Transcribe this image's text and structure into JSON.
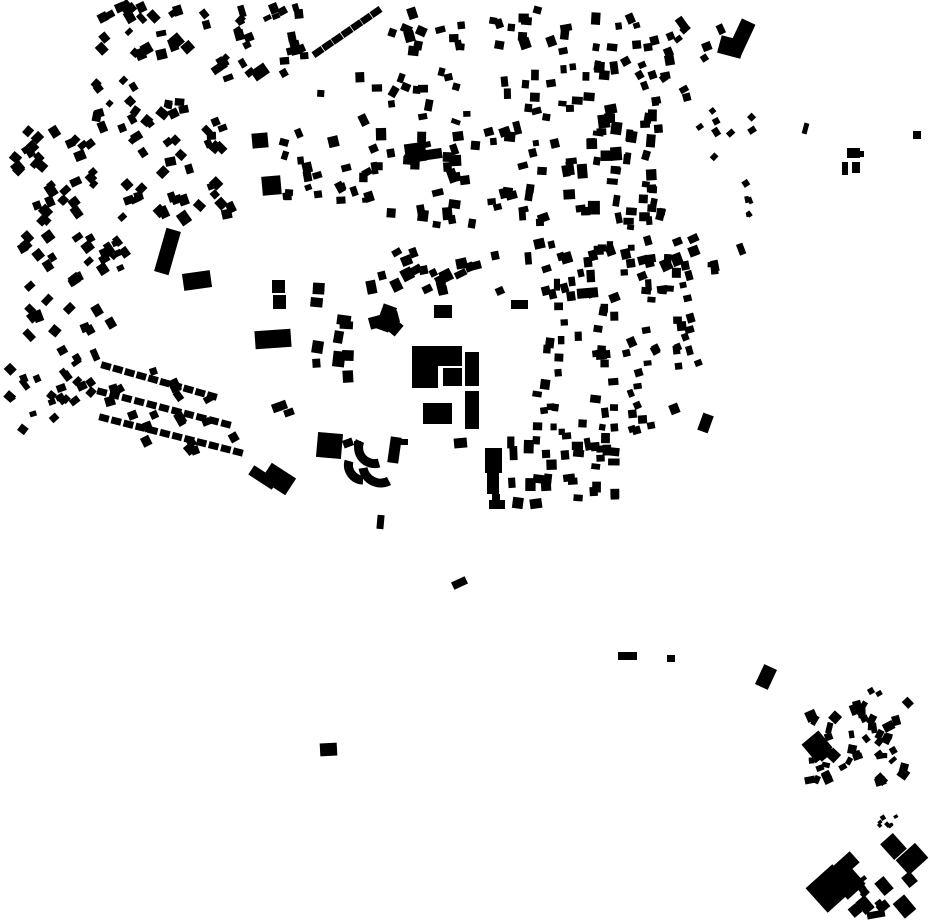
{
  "map": {
    "kind": "figure-ground building footprint map",
    "width": 930,
    "height": 924,
    "background_color": "#ffffff",
    "building_color": "#000000"
  },
  "chart_data": {
    "type": "table",
    "title": "",
    "note": "Map contains no text; data below are building footprints in pixel coordinates.",
    "buildings_xywhr": [
      [
        252,
        133,
        16,
        15,
        -5
      ],
      [
        262,
        176,
        19,
        19,
        -5
      ],
      [
        252,
        66,
        16,
        12,
        -35
      ],
      [
        160,
        229,
        15,
        45,
        16
      ],
      [
        183,
        272,
        28,
        17,
        -8
      ],
      [
        272,
        280,
        13,
        13,
        0
      ],
      [
        273,
        295,
        13,
        14,
        0
      ],
      [
        255,
        330,
        36,
        18,
        -4
      ],
      [
        272,
        402,
        15,
        9,
        -20
      ],
      [
        284,
        409,
        10,
        7,
        -20
      ],
      [
        249,
        472,
        28,
        11,
        33
      ],
      [
        264,
        469,
        29,
        20,
        33
      ],
      [
        405,
        143,
        21,
        19,
        -8
      ],
      [
        426,
        149,
        16,
        10,
        -8
      ],
      [
        379,
        305,
        14,
        26,
        20
      ],
      [
        369,
        314,
        30,
        12,
        -15
      ],
      [
        385,
        319,
        16,
        14,
        40
      ],
      [
        434,
        305,
        18,
        13,
        0
      ],
      [
        511,
        300,
        17,
        9,
        0
      ],
      [
        577,
        288,
        21,
        10,
        -5
      ],
      [
        412,
        346,
        26,
        42,
        0
      ],
      [
        437,
        346,
        25,
        20,
        0
      ],
      [
        443,
        368,
        19,
        18,
        0
      ],
      [
        465,
        352,
        14,
        34,
        0
      ],
      [
        465,
        391,
        14,
        38,
        0
      ],
      [
        423,
        403,
        29,
        21,
        0
      ],
      [
        317,
        433,
        25,
        25,
        5
      ],
      [
        343,
        439,
        10,
        8,
        -20
      ],
      [
        354,
        441,
        7,
        6,
        0
      ],
      [
        389,
        437,
        11,
        26,
        8
      ],
      [
        398,
        439,
        10,
        6,
        0
      ],
      [
        454,
        438,
        13,
        10,
        -5
      ],
      [
        485,
        448,
        17,
        25,
        0
      ],
      [
        487,
        470,
        12,
        24,
        0
      ],
      [
        492,
        494,
        8,
        13,
        0
      ],
      [
        489,
        500,
        16,
        9,
        0
      ],
      [
        377,
        515,
        7,
        14,
        5
      ],
      [
        734,
        20,
        15,
        34,
        25
      ],
      [
        719,
        38,
        24,
        18,
        15
      ],
      [
        700,
        414,
        11,
        18,
        20
      ],
      [
        803,
        123,
        5,
        11,
        15
      ],
      [
        913,
        131,
        8,
        8,
        0
      ],
      [
        847,
        148,
        13,
        10,
        0
      ],
      [
        857,
        151,
        7,
        6,
        0
      ],
      [
        842,
        162,
        6,
        13,
        0
      ],
      [
        852,
        162,
        8,
        11,
        0
      ],
      [
        452,
        579,
        15,
        8,
        -25
      ],
      [
        320,
        743,
        17,
        13,
        -3
      ],
      [
        618,
        652,
        19,
        8,
        0
      ],
      [
        667,
        655,
        8,
        7,
        0
      ],
      [
        759,
        666,
        14,
        22,
        25
      ],
      [
        868,
        688,
        6,
        6,
        -30
      ],
      [
        876,
        691,
        6,
        5,
        -30
      ],
      [
        806,
        735,
        22,
        22,
        -40
      ],
      [
        816,
        746,
        16,
        12,
        -40
      ],
      [
        885,
        836,
        17,
        21,
        -42
      ],
      [
        899,
        849,
        26,
        20,
        -42
      ],
      [
        832,
        858,
        26,
        15,
        -42
      ],
      [
        812,
        872,
        36,
        33,
        -42
      ],
      [
        836,
        869,
        24,
        26,
        -42
      ],
      [
        850,
        905,
        10,
        11,
        -40
      ],
      [
        859,
        897,
        12,
        16,
        -40
      ],
      [
        867,
        911,
        18,
        7,
        -10
      ],
      [
        877,
        902,
        12,
        9,
        -40
      ],
      [
        897,
        897,
        15,
        19,
        -40
      ],
      [
        904,
        873,
        11,
        13,
        -40
      ],
      [
        878,
        878,
        12,
        16,
        -40
      ]
    ],
    "clusters_xywh_n_smin_smax_rot_rj_seed": [
      [
        95,
        0,
        100,
        60,
        22,
        6,
        11,
        -30,
        20,
        1
      ],
      [
        198,
        4,
        58,
        50,
        9,
        6,
        10,
        -30,
        20,
        2
      ],
      [
        205,
        55,
        52,
        30,
        7,
        6,
        10,
        -35,
        15,
        3
      ],
      [
        255,
        0,
        55,
        24,
        6,
        6,
        9,
        -20,
        15,
        4
      ],
      [
        272,
        25,
        40,
        55,
        8,
        6,
        10,
        -15,
        15,
        5
      ],
      [
        88,
        72,
        55,
        40,
        7,
        6,
        9,
        -40,
        10,
        6
      ],
      [
        85,
        98,
        135,
        42,
        13,
        6,
        10,
        -20,
        35,
        7
      ],
      [
        8,
        125,
        92,
        105,
        33,
        7,
        11,
        -35,
        15,
        8
      ],
      [
        118,
        115,
        118,
        115,
        36,
        7,
        11,
        -30,
        20,
        9
      ],
      [
        270,
        115,
        42,
        100,
        10,
        6,
        10,
        0,
        25,
        10
      ],
      [
        18,
        230,
        100,
        118,
        30,
        7,
        11,
        -35,
        15,
        11
      ],
      [
        100,
        230,
        40,
        45,
        6,
        6,
        10,
        -30,
        15,
        12
      ],
      [
        5,
        345,
        95,
        95,
        26,
        6,
        10,
        -35,
        18,
        13
      ],
      [
        100,
        360,
        145,
        95,
        18,
        7,
        11,
        -28,
        12,
        14
      ],
      [
        385,
        5,
        175,
        55,
        22,
        6,
        11,
        0,
        25,
        15
      ],
      [
        312,
        62,
        76,
        163,
        20,
        6,
        11,
        -10,
        20,
        16
      ],
      [
        388,
        60,
        95,
        70,
        13,
        6,
        10,
        0,
        30,
        17
      ],
      [
        385,
        130,
        95,
        100,
        25,
        7,
        12,
        -5,
        15,
        18
      ],
      [
        480,
        60,
        80,
        168,
        30,
        6,
        11,
        -5,
        15,
        19
      ],
      [
        558,
        0,
        64,
        233,
        42,
        6,
        12,
        0,
        12,
        20
      ],
      [
        622,
        100,
        46,
        130,
        25,
        6,
        11,
        5,
        12,
        21
      ],
      [
        625,
        0,
        35,
        58,
        5,
        6,
        9,
        -10,
        15,
        22
      ],
      [
        655,
        15,
        70,
        48,
        8,
        6,
        10,
        -30,
        15,
        23
      ],
      [
        620,
        55,
        80,
        53,
        12,
        6,
        10,
        -20,
        15,
        24
      ],
      [
        692,
        105,
        68,
        58,
        8,
        5,
        8,
        -30,
        20,
        25
      ],
      [
        731,
        170,
        24,
        60,
        5,
        4,
        7,
        -20,
        20,
        26
      ],
      [
        362,
        240,
        158,
        55,
        22,
        7,
        12,
        -20,
        10,
        27
      ],
      [
        520,
        228,
        100,
        74,
        22,
        6,
        11,
        -10,
        12,
        28
      ],
      [
        620,
        230,
        125,
        73,
        30,
        6,
        11,
        -10,
        15,
        29
      ],
      [
        618,
        305,
        85,
        68,
        16,
        6,
        10,
        -15,
        15,
        30
      ],
      [
        310,
        280,
        52,
        103,
        10,
        8,
        14,
        0,
        10,
        31
      ],
      [
        532,
        302,
        40,
        158,
        15,
        6,
        10,
        0,
        10,
        32
      ],
      [
        572,
        302,
        48,
        158,
        18,
        6,
        11,
        0,
        10,
        33
      ],
      [
        620,
        368,
        62,
        58,
        7,
        6,
        10,
        -15,
        15,
        34
      ],
      [
        505,
        418,
        115,
        92,
        32,
        7,
        12,
        0,
        8,
        35
      ],
      [
        620,
        418,
        38,
        20,
        3,
        6,
        9,
        -10,
        10,
        36
      ],
      [
        800,
        697,
        112,
        95,
        46,
        5,
        11,
        0,
        45,
        37
      ],
      [
        876,
        798,
        30,
        33,
        7,
        3,
        5,
        -40,
        10,
        38
      ],
      [
        845,
        862,
        48,
        55,
        8,
        5,
        9,
        -40,
        10,
        39
      ]
    ],
    "housing_rows_x1y1x2y2_n_bw_bh": [
      [
        104,
        418,
        238,
        452,
        12,
        10,
        7
      ],
      [
        102,
        392,
        226,
        424,
        11,
        10,
        7
      ],
      [
        106,
        366,
        212,
        396,
        10,
        10,
        7
      ],
      [
        318,
        52,
        376,
        12,
        7,
        11,
        7
      ]
    ],
    "crescent_buildings": {
      "stroke_width": 9,
      "paths": [
        "M360 441 A16 16 0 0 0 379 463",
        "M349 461 A15 15 0 0 0 363 480",
        "M363 468 A18 18 0 0 0 389 481"
      ]
    }
  }
}
